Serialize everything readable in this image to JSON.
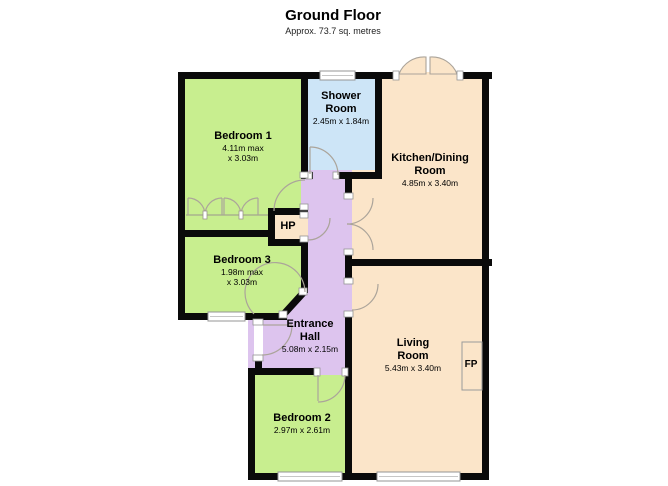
{
  "title": {
    "text": "Ground Floor",
    "subtitle": "Approx. 73.7 sq. metres"
  },
  "rooms": {
    "bedroom1": {
      "name": "Bedroom 1",
      "dim_line1": "4.11m max",
      "dim_line2": "x 3.03m"
    },
    "shower": {
      "name_line1": "Shower",
      "name_line2": "Room",
      "dims": "2.45m x 1.84m"
    },
    "kitchen": {
      "name_line1": "Kitchen/Dining",
      "name_line2": "Room",
      "dims": "4.85m x 3.40m"
    },
    "bedroom3": {
      "name": "Bedroom 3",
      "dim_line1": "1.98m max",
      "dim_line2": "x 3.03m"
    },
    "hp": {
      "name": "HP"
    },
    "hall": {
      "name_line1": "Entrance",
      "name_line2": "Hall",
      "dims": "5.08m x 2.15m"
    },
    "living": {
      "name_line1": "Living",
      "name_line2": "Room",
      "dims": "5.43m x 3.40m"
    },
    "bedroom2": {
      "name": "Bedroom 2",
      "dims": "2.97m x 2.61m"
    },
    "fireplace": {
      "label": "FP"
    }
  },
  "colors": {
    "bedroom": "#c8ee8f",
    "shower": "#cde5f7",
    "kitchen_living": "#fbe5c9",
    "hall": "#ddc4ee",
    "wall": "#0a0a0a",
    "door_arc": "#aba49a",
    "window_frame": "#959595",
    "background": "#ffffff"
  }
}
